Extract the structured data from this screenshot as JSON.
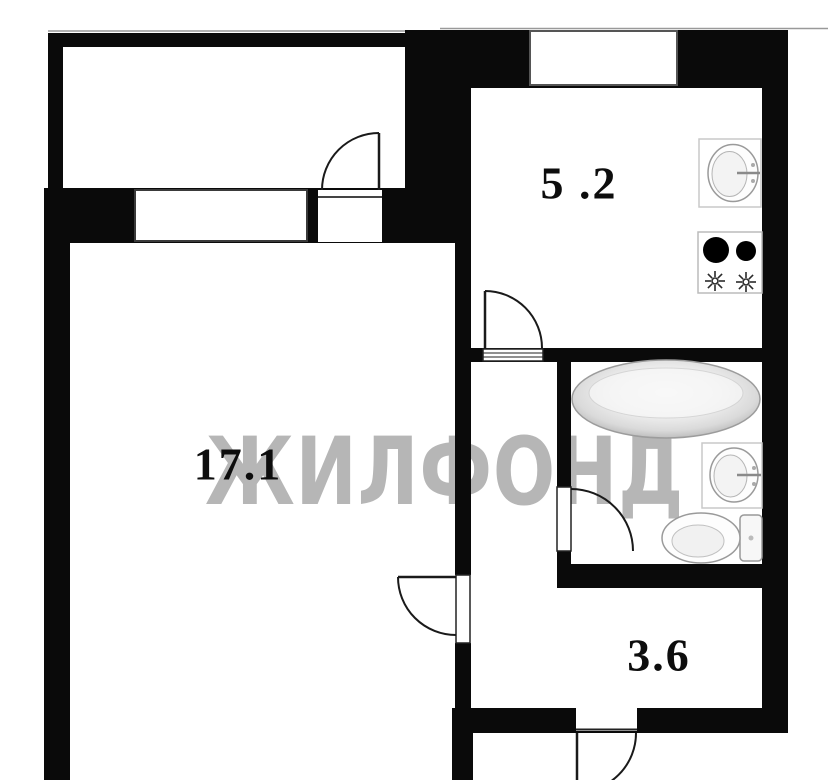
{
  "title": "apartment floor plan",
  "watermark": {
    "text": "ЖИЛФОНД",
    "color": "#b6b6b6"
  },
  "rooms": [
    {
      "name": "living-room",
      "area": "17.1"
    },
    {
      "name": "kitchen",
      "area": "5 .2"
    },
    {
      "name": "hallway",
      "area": "3.6"
    }
  ],
  "colors": {
    "wall": "#0a0a0a",
    "background": "#ffffff",
    "label": "#0d0d0d",
    "watermark": "#b6b6b6",
    "fixture_outline": "#9a9a9a"
  },
  "fixtures": [
    "kitchen-sink",
    "stove",
    "bathtub",
    "bathroom-sink",
    "toilet"
  ]
}
